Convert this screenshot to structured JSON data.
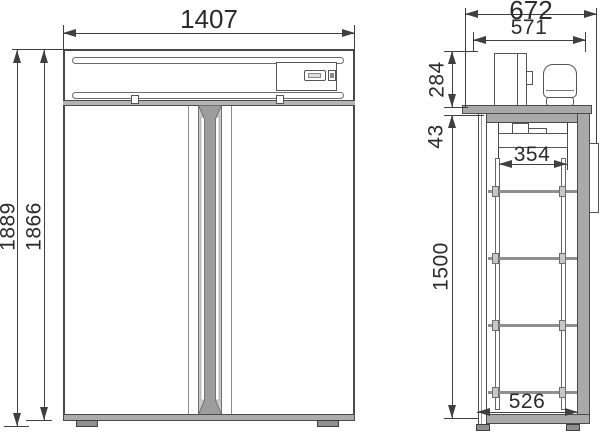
{
  "drawing": {
    "front_view": {
      "dim_width": "1407",
      "dim_height_overall": "1889",
      "dim_height_body": "1866"
    },
    "side_view": {
      "dim_depth_overall": "672",
      "dim_depth_body": "571",
      "dim_machine_compartment_height": "284",
      "dim_top_panel_offset": "43",
      "dim_evaporator_width": "354",
      "dim_interior_height": "1500",
      "dim_interior_depth": "526"
    },
    "colors": {
      "line": "#3f3f3f",
      "panel_gray": "#a9a9a9",
      "mullion_gray": "#9d9d9d"
    }
  }
}
